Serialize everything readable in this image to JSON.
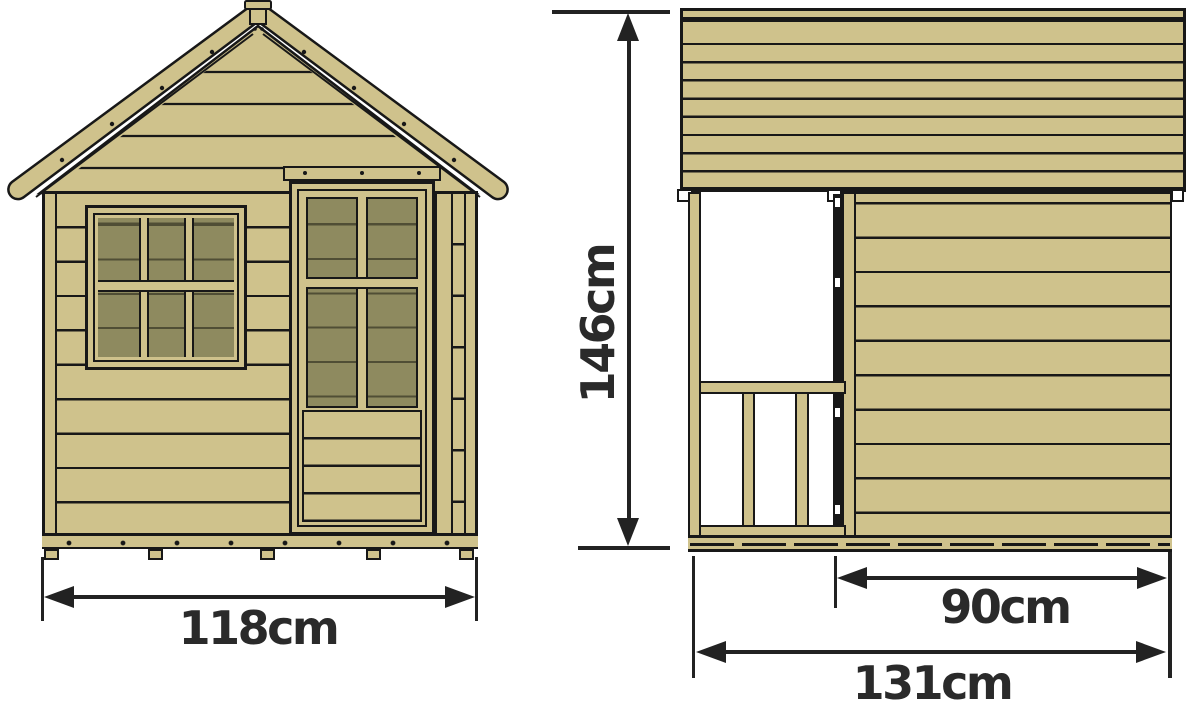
{
  "diagram": {
    "title_hint": "playhouse dimension drawing, front and side elevations",
    "colors": {
      "wood": "#cfc28c",
      "pane": "#8e8a5f",
      "outline": "#181818",
      "dim": "#222222",
      "text": "#2a2a2a",
      "bg": "#ffffff"
    },
    "views": {
      "front": {
        "width_cm": 118,
        "width_label": "118cm"
      },
      "side": {
        "height_cm": 146,
        "height_label": "146cm",
        "wall_width_cm": 90,
        "wall_width_label": "90cm",
        "total_width_cm": 131,
        "total_width_label": "131cm"
      }
    }
  }
}
